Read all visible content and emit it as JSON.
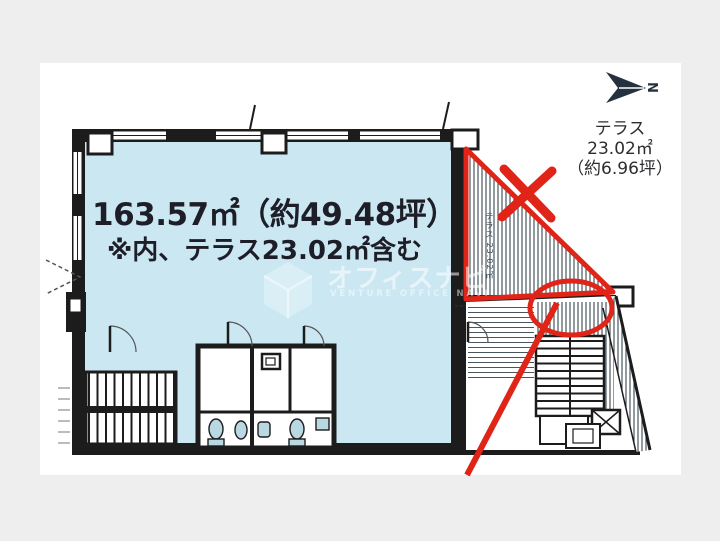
{
  "colors": {
    "page_bg": "#eeeeee",
    "panel_bg": "#ffffff",
    "room_fill": "#cbe7f2",
    "wall": "#1c1c1c",
    "highlight_red": "#e02418",
    "hatch": "#37474f",
    "text_dark": "#1e1e28",
    "compass": "#26313f"
  },
  "floor_plan": {
    "area_label": "163.57㎡（約49.48坪）",
    "area_note": "※内、テラス23.02㎡含む"
  },
  "terrace": {
    "label_line1": "テラス",
    "label_line2": "23.02㎡",
    "label_line3": "（約6.96坪）",
    "inline_label": "テラス 23.02㎡"
  },
  "compass": {
    "north_label": "N"
  },
  "watermark": {
    "brand": "オフィスナビ",
    "subtext": "VENTURE OFFICE NAVI"
  },
  "icons": {
    "north_arrow": "north-arrow-icon",
    "hexagon_logo": "hexagon-cube-logo-icon",
    "cross_mark": "red-cross-mark",
    "circle_mark": "red-ellipse-mark",
    "pointer_line": "red-pointer-line"
  }
}
